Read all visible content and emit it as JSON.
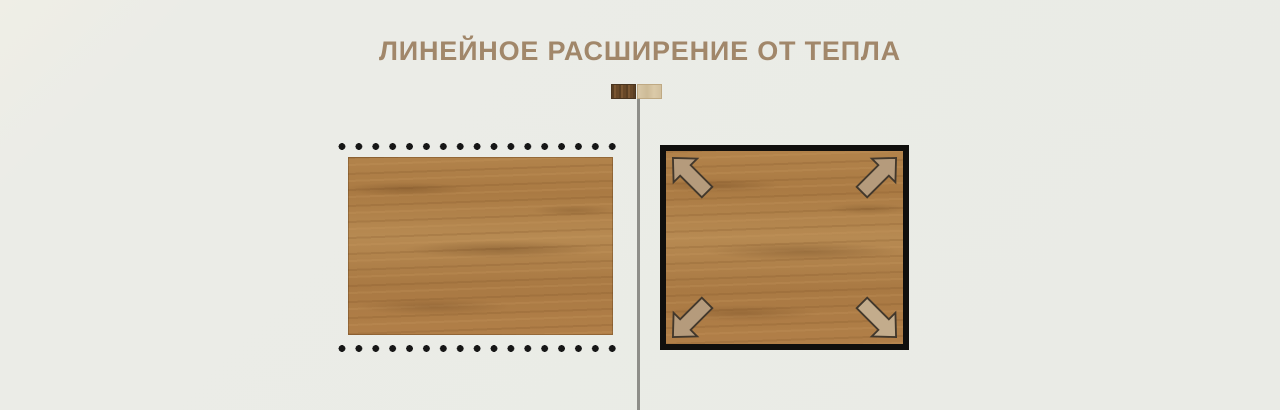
{
  "header": {
    "title": "ЛИНЕЙНОЕ РАСШИРЕНИЕ ОТ ТЕПЛА"
  },
  "colors": {
    "background": "#ebece7",
    "title": "#a1876a",
    "divider": "#8e8e89",
    "dots": "#161616",
    "frame": "#100f0d",
    "arrow_fill": "#b59b7c",
    "arrow_outline": "#42382c",
    "wood_base": "#b0804a",
    "dark_swatch": "#6b4a28",
    "light_swatch": "#d5c3a2"
  },
  "icons": {
    "legend_swatches": [
      "dark-wood-swatch",
      "light-wood-swatch"
    ],
    "corner_arrows": [
      "arrow-up-left",
      "arrow-up-right",
      "arrow-down-left",
      "arrow-down-right"
    ]
  }
}
